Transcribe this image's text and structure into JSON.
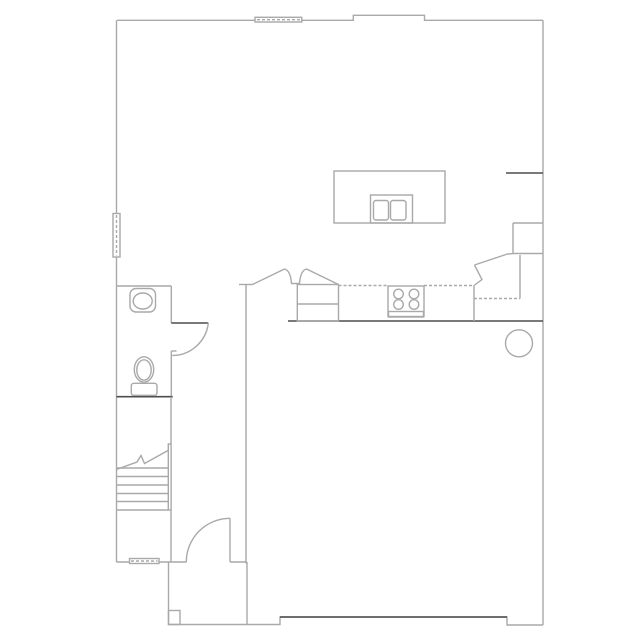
{
  "document": {
    "kind": "architectural-floor-plan",
    "floor": "first-floor",
    "text_labels": []
  },
  "canvas": {
    "width": 639,
    "height": 639,
    "background": "#ffffff"
  },
  "colors": {
    "wall_light": "#a9a9a9",
    "wall_dark": "#4d4d4d",
    "background": "#ffffff"
  },
  "chart_data": {
    "type": "floor-plan-vector",
    "elements": [
      {
        "type": "polyline",
        "name": "exterior-wall-top",
        "stroke": "light",
        "points": "117,20.3 353.3,20.3 353.3,15.3 424.5,15.3 424.5,20.3 543,20.3"
      },
      {
        "type": "line",
        "name": "exterior-wall-left",
        "stroke": "light",
        "x1": 116.5,
        "y1": 20.3,
        "x2": 116.5,
        "y2": 562
      },
      {
        "type": "line",
        "name": "exterior-wall-right",
        "stroke": "light",
        "x1": 543,
        "y1": 20.3,
        "x2": 543,
        "y2": 625
      },
      {
        "type": "line",
        "name": "garage-bottom-wall",
        "stroke": "light",
        "x1": 116.5,
        "y1": 562,
        "x2": 186.5,
        "y2": 562
      },
      {
        "type": "line",
        "name": "foyer-bottom-wall",
        "stroke": "light",
        "x1": 230,
        "y1": 562,
        "x2": 247,
        "y2": 562
      },
      {
        "type": "polyline",
        "name": "porch-outline",
        "stroke": "light",
        "points": "168.5,562 168.5,624.5 280,624.5 280,617 507,617 507,625 543,625"
      },
      {
        "type": "line",
        "name": "bottom-wall-right",
        "stroke": "dark",
        "x1": 280,
        "y1": 617,
        "x2": 507,
        "y2": 617
      },
      {
        "type": "line",
        "name": "porch-side-wall",
        "stroke": "light",
        "x1": 247,
        "y1": 562,
        "x2": 247,
        "y2": 624.5
      },
      {
        "type": "rect",
        "name": "porch-post",
        "stroke": "light",
        "fill": "none",
        "x": 168.5,
        "y": 610.5,
        "w": 11.5,
        "h": 14
      },
      {
        "type": "line",
        "name": "powder-room-top-wall",
        "stroke": "light",
        "x1": 117,
        "y1": 286,
        "x2": 171.3,
        "y2": 286
      },
      {
        "type": "line",
        "name": "powder-room-right-wall-upper",
        "stroke": "light",
        "x1": 171.3,
        "y1": 286,
        "x2": 171.3,
        "y2": 323
      },
      {
        "type": "line",
        "name": "powder-room-right-wall-lower",
        "stroke": "light",
        "x1": 171.3,
        "y1": 351,
        "x2": 171.3,
        "y2": 396.7
      },
      {
        "type": "line",
        "name": "powder-door-jamb",
        "stroke": "light",
        "x1": 171.3,
        "y1": 351,
        "x2": 176.5,
        "y2": 351
      },
      {
        "type": "line",
        "name": "powder-room-bottom-wall",
        "stroke": "dark",
        "x1": 116.5,
        "y1": 396.7,
        "x2": 172.7,
        "y2": 396.7
      },
      {
        "type": "line",
        "name": "powder-door-leaf",
        "stroke": "dark",
        "x1": 171.3,
        "y1": 323,
        "x2": 208.3,
        "y2": 323
      },
      {
        "type": "path",
        "name": "powder-door-swing",
        "stroke": "light",
        "d": "M208.3,323 A36.5,36.5 0 0 1 172.3,355.5"
      },
      {
        "type": "line",
        "name": "hall-wall-upper",
        "stroke": "light",
        "x1": 171,
        "y1": 396.7,
        "x2": 171,
        "y2": 444
      },
      {
        "type": "rect",
        "name": "stair-wall",
        "stroke": "light",
        "fill": "none",
        "x": 168.3,
        "y": 444,
        "w": 2.8,
        "h": 66
      },
      {
        "type": "line",
        "name": "hall-wall-lower",
        "stroke": "light",
        "x1": 171,
        "y1": 510,
        "x2": 171,
        "y2": 562
      },
      {
        "type": "line",
        "name": "stair-tread",
        "stroke": "light",
        "x1": 116.5,
        "y1": 468,
        "x2": 168.3,
        "y2": 468
      },
      {
        "type": "line",
        "name": "stair-tread",
        "stroke": "light",
        "x1": 116.5,
        "y1": 476.5,
        "x2": 168.3,
        "y2": 476.5
      },
      {
        "type": "line",
        "name": "stair-tread",
        "stroke": "light",
        "x1": 116.5,
        "y1": 485,
        "x2": 168.3,
        "y2": 485
      },
      {
        "type": "line",
        "name": "stair-tread",
        "stroke": "light",
        "x1": 116.5,
        "y1": 493.5,
        "x2": 168.3,
        "y2": 493.5
      },
      {
        "type": "line",
        "name": "stair-tread",
        "stroke": "light",
        "x1": 116.5,
        "y1": 501.5,
        "x2": 168.3,
        "y2": 501.5
      },
      {
        "type": "line",
        "name": "stair-tread",
        "stroke": "light",
        "x1": 116.5,
        "y1": 510,
        "x2": 168.3,
        "y2": 510
      },
      {
        "type": "path",
        "name": "stair-direction-line",
        "stroke": "light",
        "d": "M116.5,469.5 L137,462 L141,455.5 L144.5,463.5 L168,450.5"
      },
      {
        "type": "line",
        "name": "foyer-family-wall",
        "stroke": "light",
        "x1": 246,
        "y1": 284.5,
        "x2": 246,
        "y2": 563.5
      },
      {
        "type": "line",
        "name": "foyer-family-wall-cap",
        "stroke": "light",
        "x1": 239,
        "y1": 284.5,
        "x2": 252.5,
        "y2": 284.5
      },
      {
        "type": "path",
        "name": "arched-opening-kitchen",
        "stroke": "light",
        "d": "M252.5,284.5 L284.5,269 Q290.5,270.5 291.5,283.5 L299.5,283.5 Q300.5,270.5 306.5,269 L338.5,284.5"
      },
      {
        "type": "line",
        "name": "kitchen-family-wall",
        "stroke": "dark",
        "x1": 288,
        "y1": 321,
        "x2": 543,
        "y2": 321
      },
      {
        "type": "line",
        "name": "wall-stub-right",
        "stroke": "dark",
        "x1": 506,
        "y1": 173,
        "x2": 543,
        "y2": 173
      },
      {
        "type": "rect",
        "name": "refrigerator",
        "stroke": "light",
        "fill": "none",
        "x": 297.3,
        "y": 284.5,
        "w": 41.2,
        "h": 36.5
      },
      {
        "type": "line",
        "name": "refrigerator-divider",
        "stroke": "light",
        "x1": 297.3,
        "y1": 304,
        "x2": 338.5,
        "y2": 304
      },
      {
        "type": "line",
        "name": "counter-edge",
        "stroke": "light",
        "dash": true,
        "x1": 338.5,
        "y1": 285.5,
        "x2": 388,
        "y2": 285.5
      },
      {
        "type": "line",
        "name": "counter-edge",
        "stroke": "light",
        "dash": true,
        "x1": 424,
        "y1": 285.5,
        "x2": 474,
        "y2": 285.5
      },
      {
        "type": "line",
        "name": "counter-end",
        "stroke": "light",
        "x1": 474,
        "y1": 285.5,
        "x2": 474,
        "y2": 321
      },
      {
        "type": "line",
        "name": "counter-edge",
        "stroke": "light",
        "dash": true,
        "x1": 474,
        "y1": 298.5,
        "x2": 520,
        "y2": 298.5
      },
      {
        "type": "line",
        "name": "counter-end",
        "stroke": "light",
        "x1": 520,
        "y1": 255,
        "x2": 520,
        "y2": 298.5
      },
      {
        "type": "line",
        "name": "pantry-top",
        "stroke": "light",
        "x1": 513,
        "y1": 223,
        "x2": 543,
        "y2": 223
      },
      {
        "type": "line",
        "name": "pantry-left",
        "stroke": "light",
        "x1": 513,
        "y1": 223,
        "x2": 513,
        "y2": 253.5
      },
      {
        "type": "line",
        "name": "pantry-bottom",
        "stroke": "light",
        "x1": 513,
        "y1": 253.5,
        "x2": 543,
        "y2": 253.5
      },
      {
        "type": "line",
        "name": "angled-counter-edge",
        "stroke": "light",
        "x1": 474.5,
        "y1": 265,
        "x2": 506,
        "y2": 254.5
      },
      {
        "type": "line",
        "name": "angled-counter-edge-end",
        "stroke": "light",
        "x1": 506,
        "y1": 254.2,
        "x2": 513,
        "y2": 253.6
      },
      {
        "type": "polyline",
        "name": "break-symbol",
        "stroke": "light",
        "points": "474.5,265 482,279.5 474,285.5"
      },
      {
        "type": "rect",
        "name": "kitchen-island",
        "stroke": "light",
        "fill": "none",
        "x": 334,
        "y": 171,
        "w": 111,
        "h": 52
      },
      {
        "type": "rect",
        "name": "island-sink",
        "stroke": "light",
        "fill": "none",
        "x": 370.5,
        "y": 195,
        "w": 42,
        "h": 28
      },
      {
        "type": "rect",
        "name": "island-sink-basin-left",
        "stroke": "light",
        "fill": "none",
        "rx": 2.5,
        "x": 373.5,
        "y": 200.5,
        "w": 15,
        "h": 19.5
      },
      {
        "type": "rect",
        "name": "island-sink-basin-right",
        "stroke": "light",
        "fill": "none",
        "rx": 2.5,
        "x": 390.5,
        "y": 200.5,
        "w": 15.5,
        "h": 19.5
      },
      {
        "type": "rect",
        "name": "cooktop",
        "stroke": "light",
        "fill": "none",
        "x": 388,
        "y": 286,
        "w": 36,
        "h": 30.5
      },
      {
        "type": "circle",
        "name": "burner",
        "stroke": "light",
        "cx": 398.5,
        "cy": 294,
        "r": 4.8
      },
      {
        "type": "circle",
        "name": "burner",
        "stroke": "light",
        "cx": 414,
        "cy": 294,
        "r": 4.8
      },
      {
        "type": "circle",
        "name": "burner",
        "stroke": "light",
        "cx": 398.5,
        "cy": 304.5,
        "r": 4.8
      },
      {
        "type": "circle",
        "name": "burner",
        "stroke": "light",
        "cx": 414,
        "cy": 304.5,
        "r": 4.8
      },
      {
        "type": "rect",
        "name": "cooktop-front-panel",
        "stroke": "light",
        "fill": "none",
        "x": 388.5,
        "y": 311.5,
        "w": 35,
        "h": 5.5
      },
      {
        "type": "circle",
        "name": "water-heater",
        "stroke": "light",
        "cx": 519,
        "cy": 343.3,
        "r": 13.5
      },
      {
        "type": "rect",
        "name": "vanity-sink",
        "stroke": "light",
        "fill": "none",
        "rx": 6,
        "x": 130,
        "y": 288.5,
        "w": 25.5,
        "h": 23.5
      },
      {
        "type": "ellipse",
        "name": "vanity-sink-basin",
        "stroke": "light",
        "cx": 142.7,
        "cy": 301,
        "rx": 9.5,
        "ry": 8
      },
      {
        "type": "ellipse",
        "name": "toilet-bowl",
        "stroke": "light",
        "cx": 144,
        "cy": 369.5,
        "rx": 9.7,
        "ry": 12.7
      },
      {
        "type": "ellipse",
        "name": "toilet-bowl-inner",
        "stroke": "light",
        "cx": 144,
        "cy": 370,
        "rx": 7.2,
        "ry": 10.2
      },
      {
        "type": "rect",
        "name": "toilet-tank",
        "stroke": "light",
        "fill": "#ffffff",
        "rx": 2.5,
        "x": 131.3,
        "y": 383.3,
        "w": 25.7,
        "h": 12
      },
      {
        "type": "line",
        "name": "entry-door-leaf",
        "stroke": "light",
        "x1": 230,
        "y1": 518.3,
        "x2": 230,
        "y2": 562
      },
      {
        "type": "path",
        "name": "entry-door-swing",
        "stroke": "light",
        "d": "M230,518.3 A43.7,43.7 0 0 0 186.3,562"
      },
      {
        "type": "rect",
        "name": "window-top",
        "stroke": "light",
        "fill": "#ffffff",
        "x": 255,
        "y": 17.3,
        "w": 46.7,
        "h": 4.7
      },
      {
        "type": "line",
        "name": "window-top-glass-line",
        "stroke": "light",
        "dash": true,
        "x1": 257,
        "y1": 19.7,
        "x2": 300,
        "y2": 19.7
      },
      {
        "type": "rect",
        "name": "window-left",
        "stroke": "light",
        "fill": "#ffffff",
        "x": 113,
        "y": 213.5,
        "w": 7,
        "h": 43.5
      },
      {
        "type": "line",
        "name": "window-left-glass-line",
        "stroke": "light",
        "dash": true,
        "x1": 116.5,
        "y1": 215,
        "x2": 116.5,
        "y2": 255.5
      },
      {
        "type": "rect",
        "name": "window-bottom",
        "stroke": "light",
        "fill": "#ffffff",
        "x": 129.5,
        "y": 558.5,
        "w": 29.5,
        "h": 5
      },
      {
        "type": "line",
        "name": "window-bottom-glass-line",
        "stroke": "light",
        "dash": true,
        "x1": 131,
        "y1": 561,
        "x2": 157.5,
        "y2": 561
      }
    ]
  }
}
